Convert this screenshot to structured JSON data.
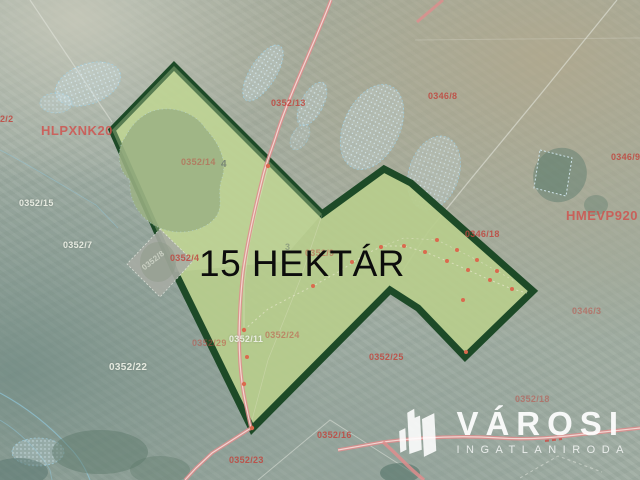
{
  "map": {
    "area_label": "15 HEKTÁR",
    "watermarks": {
      "code_left": "HLPXNK20",
      "code_right": "HMEVP920"
    },
    "parcel_labels": [
      {
        "text": "2/2"
      },
      {
        "text": "0352/13"
      },
      {
        "text": "0346/8"
      },
      {
        "text": "0346/9"
      },
      {
        "text": "0346/18"
      },
      {
        "text": "0346/3"
      },
      {
        "text": "0352/15"
      },
      {
        "text": "0352/7"
      },
      {
        "text": "0352/14"
      },
      {
        "text": "4"
      },
      {
        "text": "0352/8"
      },
      {
        "text": "0352/4"
      },
      {
        "text": "3"
      },
      {
        "text": "0352/9"
      },
      {
        "text": "0352/29"
      },
      {
        "text": "0352/11"
      },
      {
        "text": "0352/24"
      },
      {
        "text": "0352/25"
      },
      {
        "text": "0352/22"
      },
      {
        "text": "0352/16"
      },
      {
        "text": "0352/23"
      },
      {
        "text": "0352/18"
      }
    ]
  },
  "logo": {
    "brand": "VÁROSI",
    "subtitle": "INGATLANIRODA",
    "icon": "city-buildings-icon"
  },
  "colors": {
    "parcel_fill": "#b7cd8c",
    "parcel_border": "#1d4a27",
    "road_pink": "#df8d8d",
    "label_red": "#c0473f",
    "label_white": "#eef1e7",
    "watermark_red": "#d14f4b",
    "hydro_cyan": "#9fd0e4",
    "title_black": "#0c0c0c",
    "logo_white": "#ffffff"
  }
}
